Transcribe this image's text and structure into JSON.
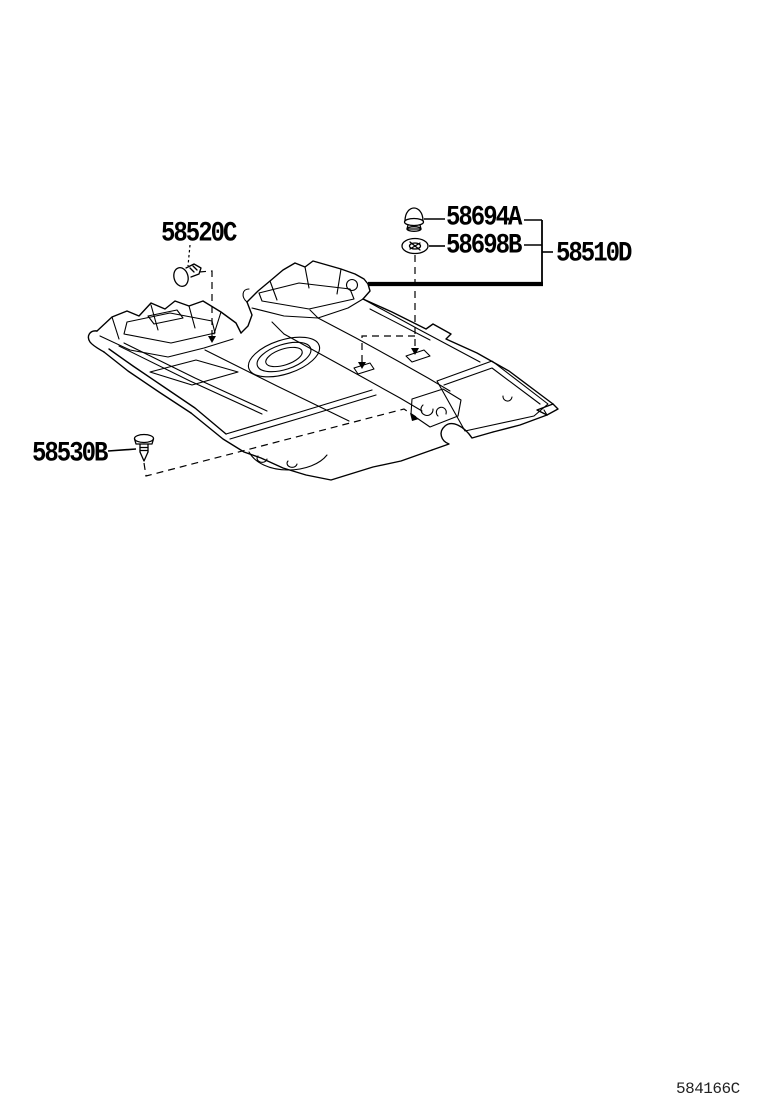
{
  "parts": [
    {
      "number": "58520C",
      "role": "trim-clip"
    },
    {
      "number": "58694A",
      "role": "mushroom-clip"
    },
    {
      "number": "58698B",
      "role": "carpet-hook-grommet"
    },
    {
      "number": "58510D",
      "role": "floor-carpet-assembly"
    },
    {
      "number": "58530B",
      "role": "push-rivet"
    }
  ],
  "icons": {
    "i58520c": "trim-clip-icon",
    "i58694a": "mushroom-clip-icon",
    "i58698b": "carpet-hook-grommet-icon",
    "i58530b": "push-rivet-icon"
  },
  "footer": {
    "figure_code": "584166C"
  },
  "colors": {
    "line": "#000000",
    "background": "#ffffff"
  }
}
